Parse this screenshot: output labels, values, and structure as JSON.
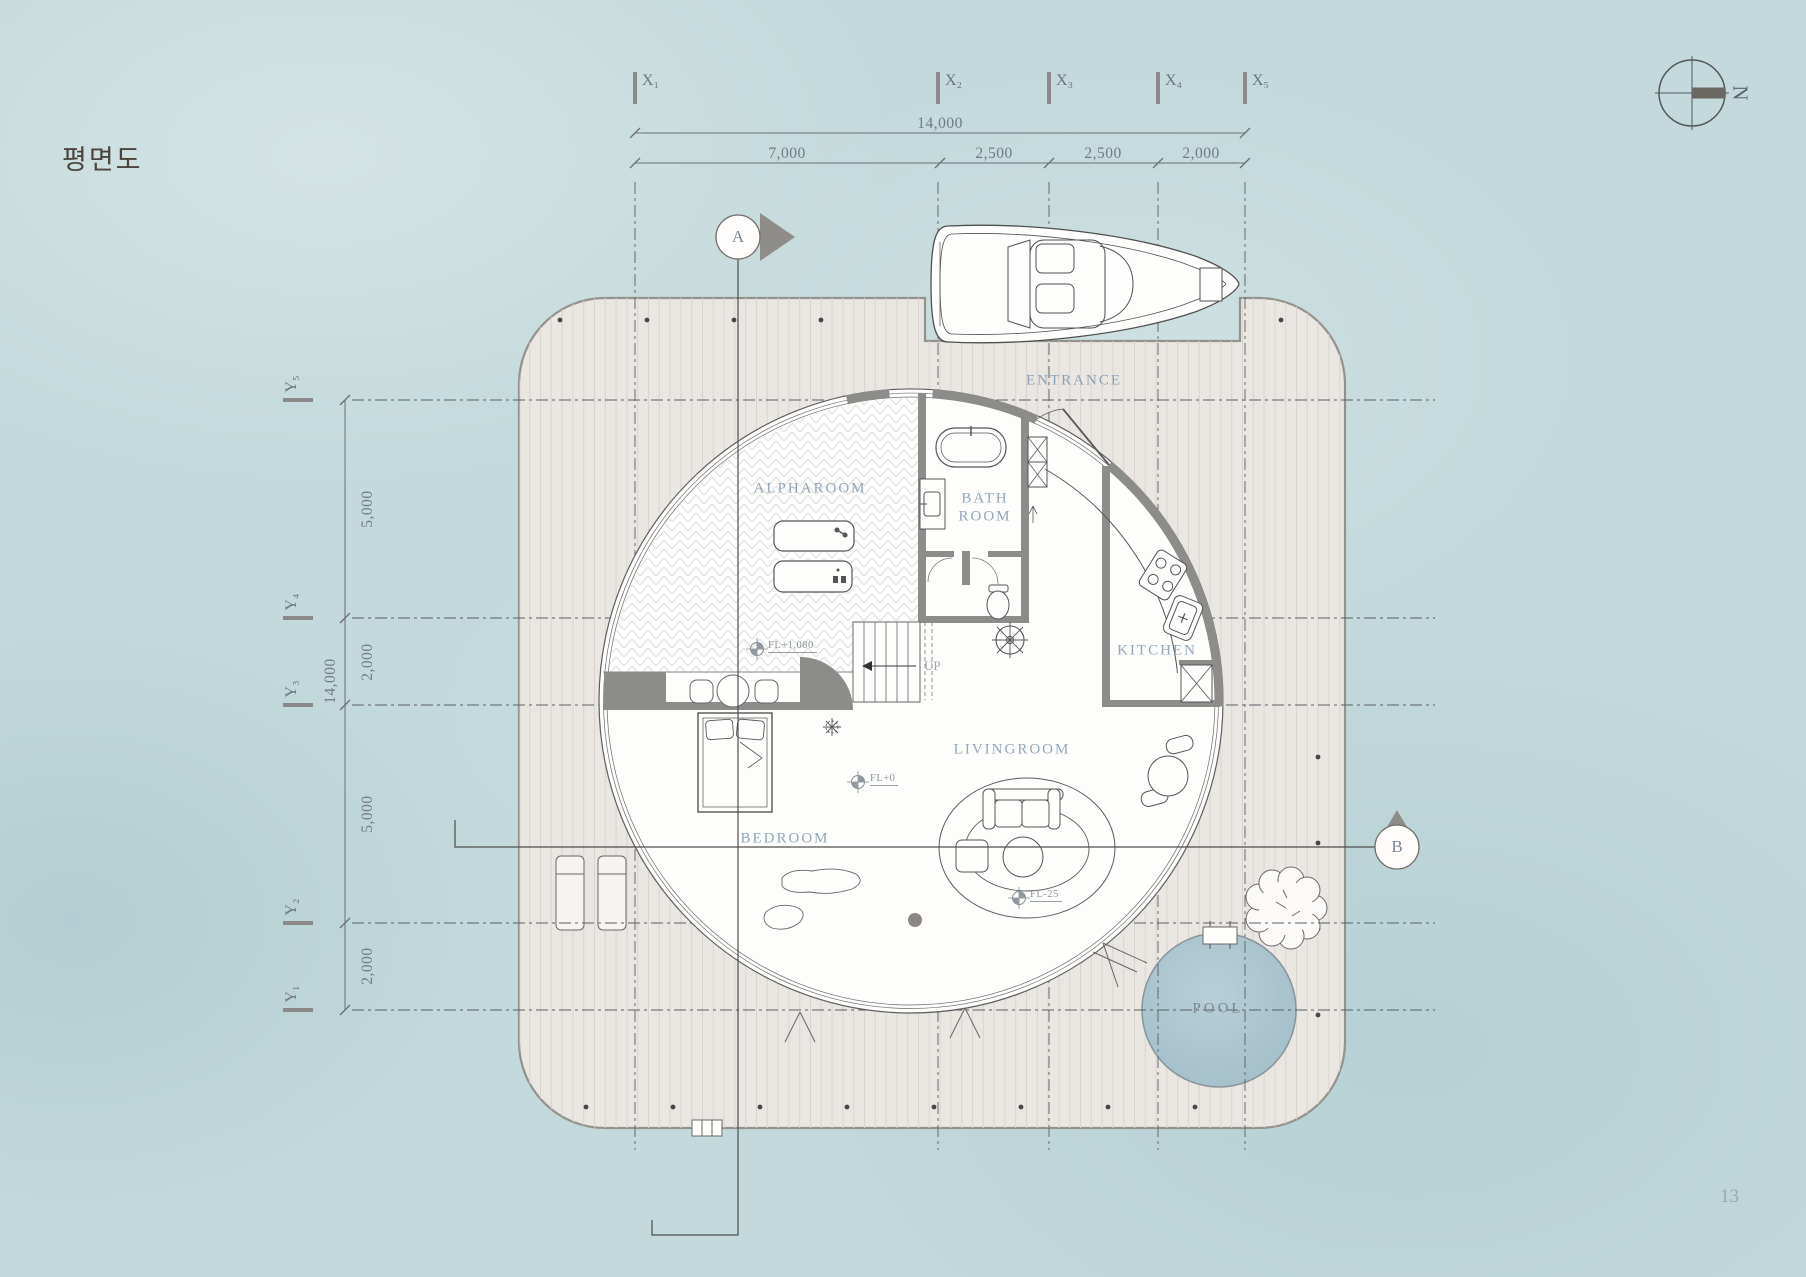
{
  "title": "평면도",
  "page_number": "13",
  "compass": {
    "north": "N"
  },
  "section_markers": {
    "a": "A",
    "b": "B"
  },
  "grid": {
    "x": [
      "X₁",
      "X₂",
      "X₃",
      "X₄",
      "X₅"
    ],
    "y": [
      "Y₁",
      "Y₂",
      "Y₃",
      "Y₄",
      "Y₅"
    ]
  },
  "dimensions": {
    "top_total": "14,000",
    "top_segments": [
      "7,000",
      "2,500",
      "2,500",
      "2,000"
    ],
    "left_total": "14,000",
    "left_segments": [
      "5,000",
      "2,000",
      "5,000",
      "2,000"
    ]
  },
  "rooms": {
    "alpharoom": "ALPHAROOM",
    "bathroom": [
      "BATH",
      "ROOM"
    ],
    "kitchen": "KITCHEN",
    "livingroom": "LIVINGROOM",
    "bedroom": "BEDROOM",
    "entrance": "ENTRANCE",
    "pool": "POOL"
  },
  "levels": {
    "alpharoom": "FL+1,080",
    "main": "FL+0",
    "lounge": "FL-25"
  },
  "stairs": {
    "up": "UP"
  },
  "colors": {
    "background": "#c3d9db",
    "deck": "#eae6e2",
    "wall": "#8c8c8a",
    "pool": "#abc5cf",
    "room_label": "#93a7b8",
    "line": "#5a5a5a"
  }
}
